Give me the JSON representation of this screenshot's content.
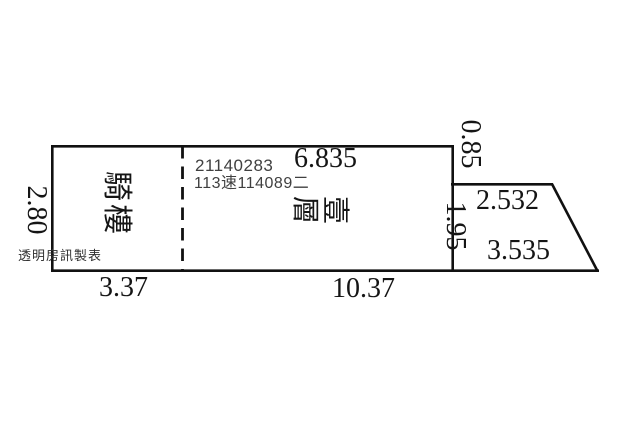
{
  "plan": {
    "room_labels": {
      "arcade": "騎樓",
      "floor": "壹層"
    },
    "registry": {
      "line1": "21140283",
      "line2": "113速114089二"
    },
    "credit": "透明房訊製表",
    "dimensions": {
      "left_height": "2.80",
      "top_width": "6.835",
      "right_upper": "0.85",
      "right_lower": "1.95",
      "notch_width": "2.532",
      "slant_length": "3.535",
      "bottom_left_width": "3.37",
      "bottom_right_width": "10.37"
    },
    "colors": {
      "ink": "#111111",
      "registry_text": "#404040",
      "background": "#ffffff"
    }
  }
}
